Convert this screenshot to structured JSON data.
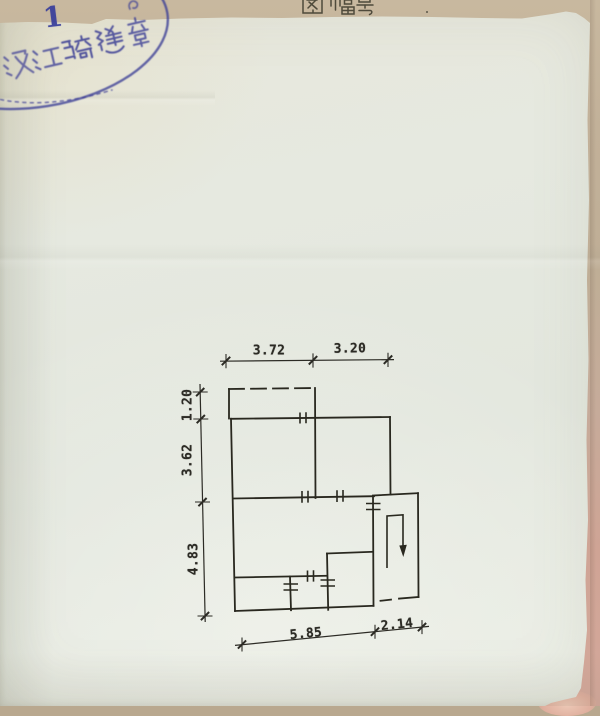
{
  "document": {
    "header_label": "图幅号",
    "page_number": "1"
  },
  "stamp": {
    "text": "汉江骑缝章",
    "shape": "ellipse-cross-seam-seal",
    "ink_color": "#3d3f96"
  },
  "floor_plan": {
    "ink_color": "#29281f",
    "dimensions_m": {
      "top": [
        "3.72",
        "3.20"
      ],
      "left": [
        "1.20",
        "3.62",
        "4.83"
      ],
      "bottom": [
        "5.85",
        "2.14"
      ]
    },
    "symbols": [
      "balcony-dashed-outline",
      "window-double-tick-symbols",
      "stair-down-arrow"
    ]
  },
  "palette": {
    "paper": "#e6e9e0",
    "backing_paper_top": "#c2b199",
    "backing_paper_bottom": "#d4a89b",
    "pencil_ink": "#2c2b25"
  }
}
